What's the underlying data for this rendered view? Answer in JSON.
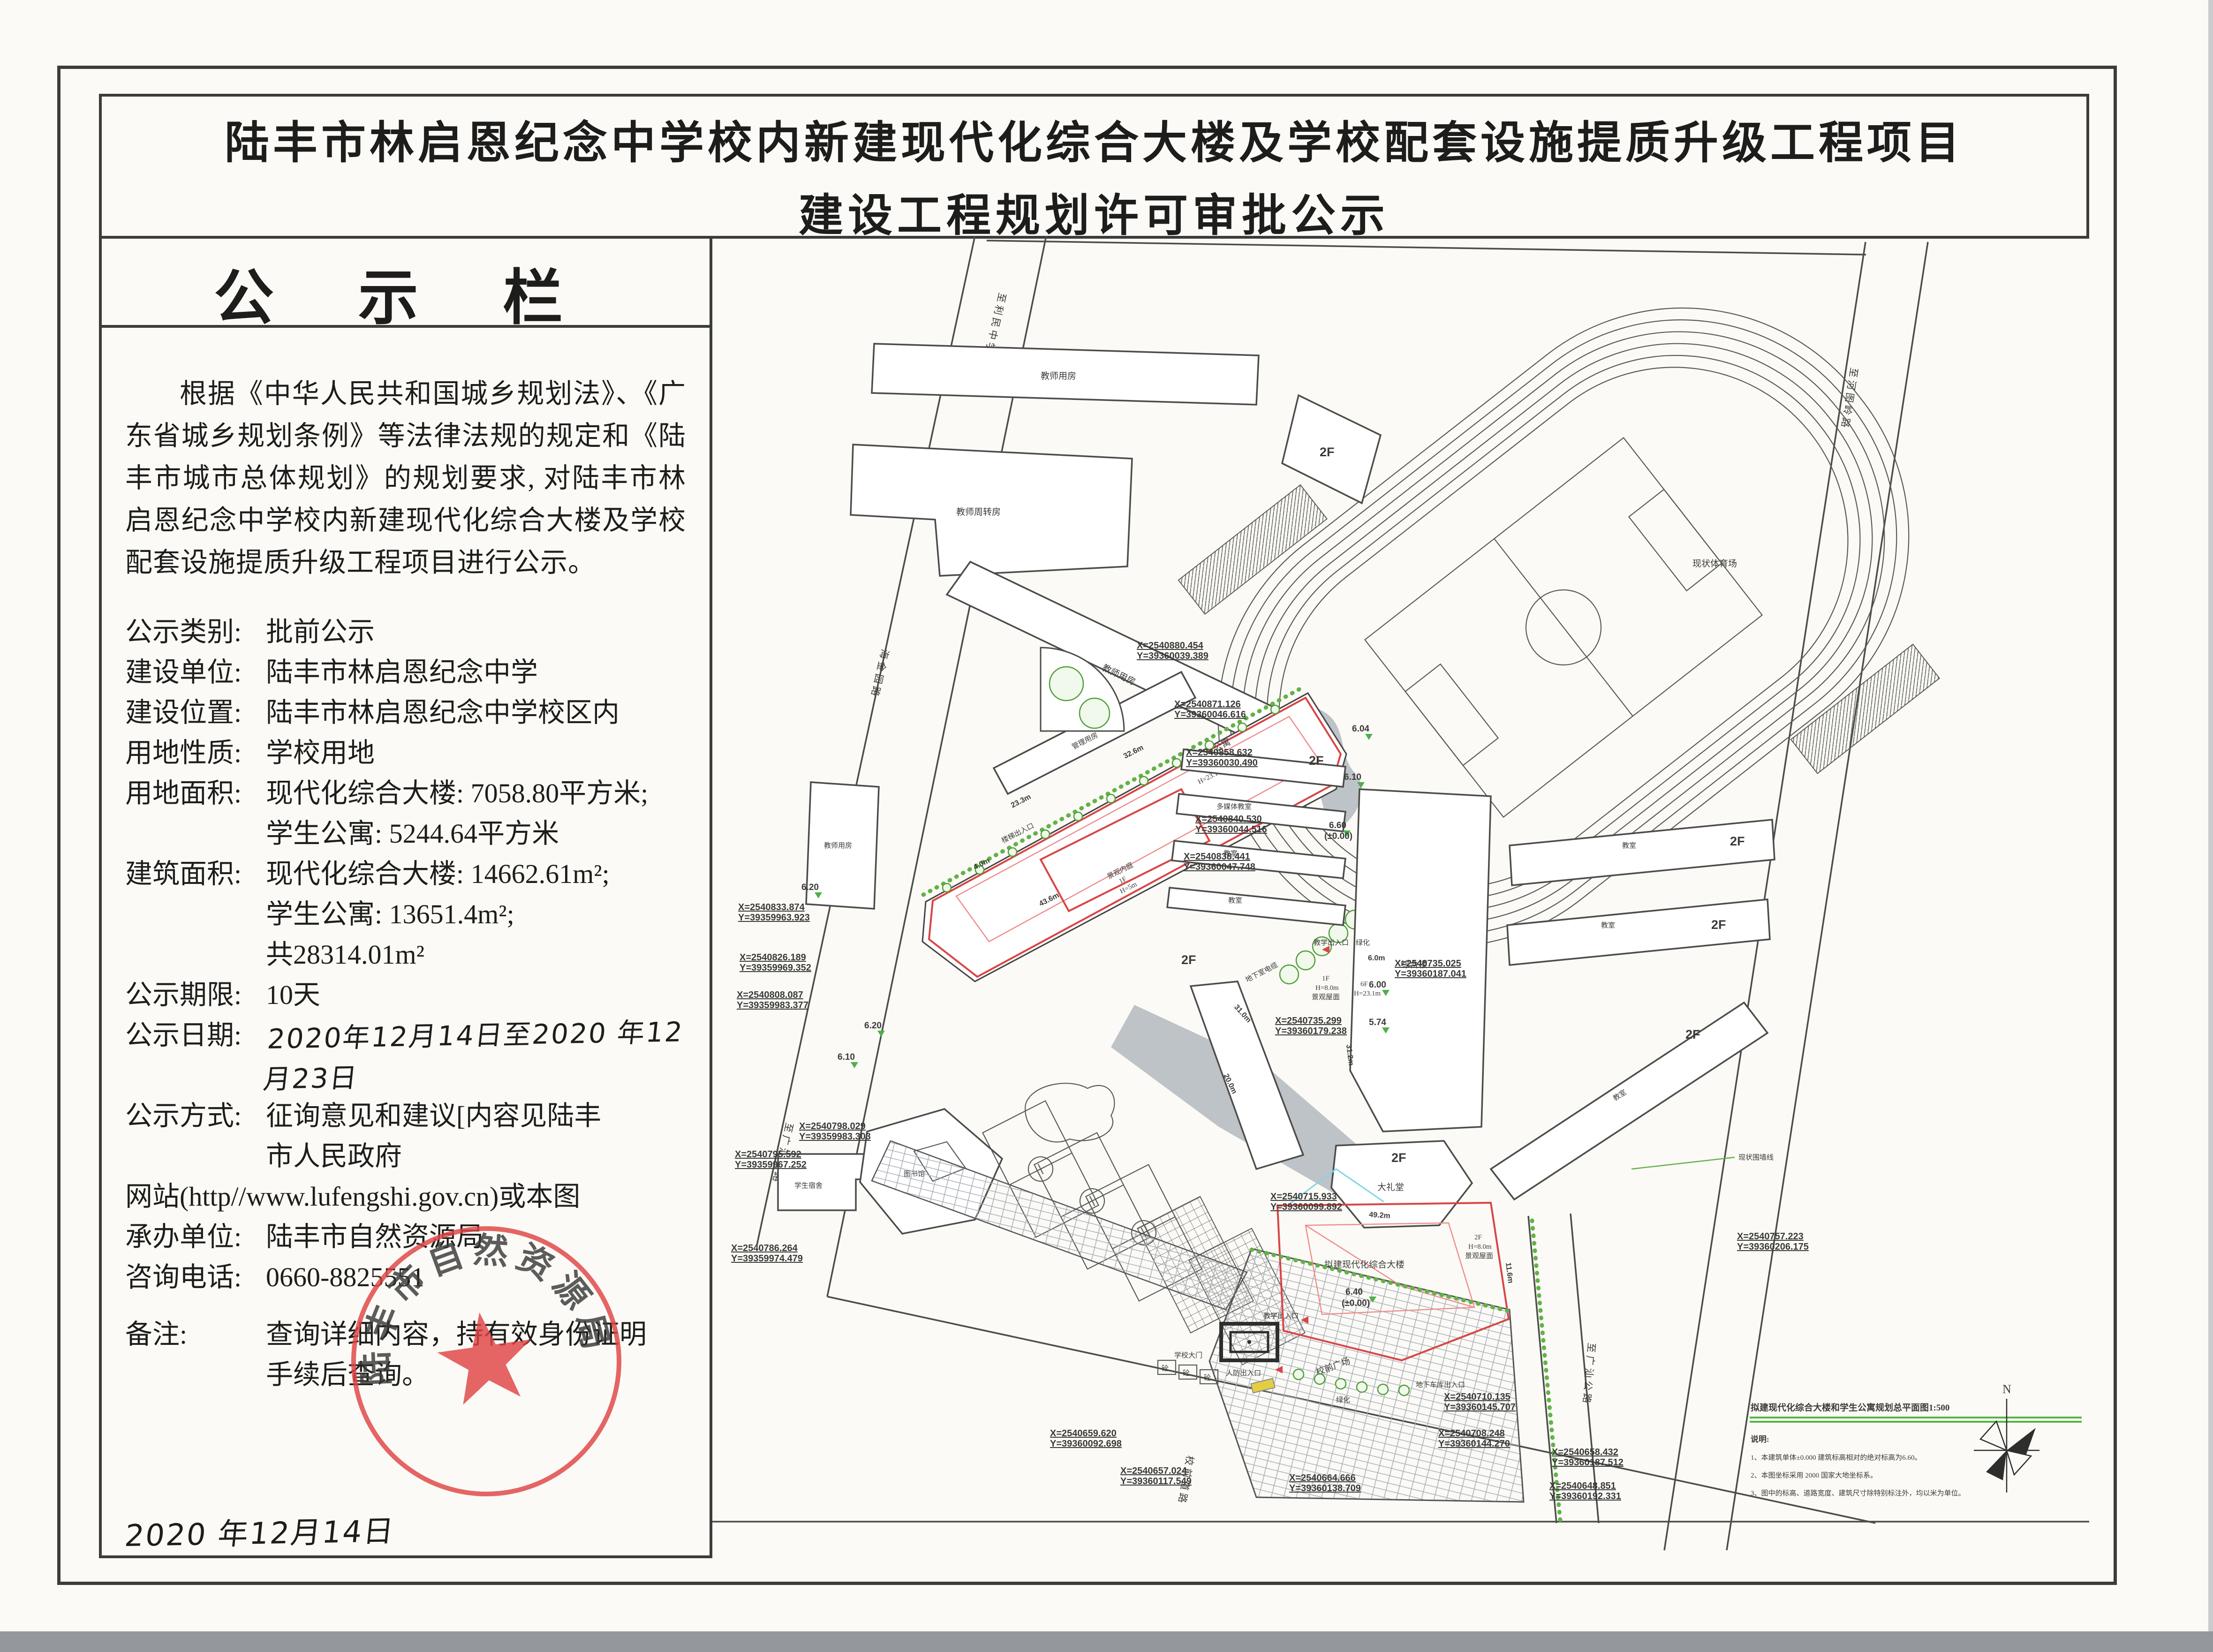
{
  "title": {
    "line1": "陆丰市林启恩纪念中学校内新建现代化综合大楼及学校配套设施提质升级工程项目",
    "line2": "建设工程规划许可审批公示"
  },
  "board": {
    "header": "公 示 栏",
    "intro": "根据《中华人民共和国城乡规划法》、《广东省城乡规划条例》等法律法规的规定和《陆丰市城市总体规划》的规划要求, 对陆丰市林启恩纪念中学校内新建现代化综合大楼及学校配套设施提质升级工程项目进行公示。",
    "fields": [
      {
        "label": "公示类别:",
        "value": "批前公示"
      },
      {
        "label": "建设单位:",
        "value": "陆丰市林启恩纪念中学"
      },
      {
        "label": "建设位置:",
        "value": "陆丰市林启恩纪念中学校区内"
      },
      {
        "label": "用地性质:",
        "value": "学校用地"
      },
      {
        "label": "用地面积:",
        "value": "现代化综合大楼: 7058.80平方米;",
        "value2": "学生公寓: 5244.64平方米"
      },
      {
        "label": "建筑面积:",
        "value": "现代化综合大楼: 14662.61m²;",
        "value2": "学生公寓: 13651.4m²;",
        "value3": "共28314.01m²"
      },
      {
        "label": "公示期限:",
        "value": "10天"
      },
      {
        "label": "公示日期:",
        "value": "2020年12月14日至2020 年12 月23日"
      },
      {
        "label": "公示方式:",
        "value": "征询意见和建议[内容见陆丰",
        "value2": "市人民政府"
      },
      {
        "label": "网站",
        "value": "(http//www.lufengshi.gov.cn)或本图"
      },
      {
        "label": "承办单位:",
        "value": "陆丰市自然资源局"
      },
      {
        "label": "咨询电话:",
        "value": "0660-8825551"
      },
      {
        "label": "备注:",
        "value": "查询详细内容，持有效身份证明",
        "value2": "手续后查询。"
      }
    ],
    "stamp": "陆丰市自然资源局",
    "sign_date": "2020 年12月14日"
  },
  "map": {
    "roads": {
      "to_limin": "至利民中学",
      "left_road": "海金园路",
      "to_guangshan_w": "至广汕公路",
      "to_hetuling": "至河图岭路",
      "to_guangshan_e": "至广汕公路",
      "xiaoqian": "校前道路"
    },
    "stadium": "现状体育场",
    "buildings": {
      "teacher": "教师用房",
      "teacher_turn": "教师周转房",
      "admin": "管理用房",
      "multimedia": "多媒体教室",
      "classroom": "教室",
      "complex": "综合楼",
      "hall": "大礼堂",
      "dorm": "学生宿舍",
      "library": "图书馆",
      "f2": "2F"
    },
    "proposed": {
      "apt": "拟建学生公寓",
      "apt_f": "6F",
      "apt_h": "H=23.10m",
      "court": "景观内庭",
      "court_f": "1F",
      "court_h": "H=5m",
      "main": "拟建现代化综合大楼",
      "elev_main": "6.40",
      "elev_main2": "(±0.00)",
      "elev_apt": "6.60",
      "elev_apt2": "(±0.00)"
    },
    "labels": {
      "teach_entry": "教学出入口",
      "civil_entry": "人防出入口",
      "gate": "学校大门",
      "garage": "地下车库出入口",
      "stair": "楼梯出入口",
      "green": "绿化",
      "conc": "砼",
      "cable": "地下室电缆",
      "wall": "现状围墙线",
      "plaza": "校前广场",
      "roof1a": "1F",
      "roof1b": "H=8.0m",
      "roof1c": "景观屋面",
      "roof6a": "6F",
      "roof6b": "H=23.1m",
      "roof2a": "2F",
      "roof2b": "H=8.0m",
      "roof2c": "景观屋面"
    },
    "elevations": [
      "6.20",
      "6.10",
      "6.04",
      "6.00",
      "5.74",
      "6.20",
      "6.10"
    ],
    "dims": [
      "6.0m",
      "20.0m",
      "31.0m",
      "31.2m",
      "49.2m",
      "32.6m",
      "11.6m",
      "23.3m",
      "43.6m",
      "4.0m"
    ],
    "coords": [
      {
        "x": "X=2540880.454",
        "y": "Y=39360039.389"
      },
      {
        "x": "X=2540871.126",
        "y": "Y=39360046.616"
      },
      {
        "x": "X=2540858.632",
        "y": "Y=39360030.490"
      },
      {
        "x": "X=2540840.530",
        "y": "Y=39360044.516"
      },
      {
        "x": "X=2540838.441",
        "y": "Y=39360047.748"
      },
      {
        "x": "X=2540757.223",
        "y": "Y=39360206.175"
      },
      {
        "x": "X=2540735.299",
        "y": "Y=39360179.238"
      },
      {
        "x": "X=2540735.025",
        "y": "Y=39360187.041"
      },
      {
        "x": "X=2540833.874",
        "y": "Y=39359963.923"
      },
      {
        "x": "X=2540826.189",
        "y": "Y=39359969.352"
      },
      {
        "x": "X=2540808.087",
        "y": "Y=39359983.377"
      },
      {
        "x": "X=2540798.029",
        "y": "Y=39359983.303"
      },
      {
        "x": "X=2540795.592",
        "y": "Y=39359967.252"
      },
      {
        "x": "X=2540786.264",
        "y": "Y=39359974.479"
      },
      {
        "x": "X=2540715.933",
        "y": "Y=39360099.892"
      },
      {
        "x": "X=2540710.135",
        "y": "Y=39360145.707"
      },
      {
        "x": "X=2540708.248",
        "y": "Y=39360144.270"
      },
      {
        "x": "X=2540659.620",
        "y": "Y=39360092.698"
      },
      {
        "x": "X=2540657.024",
        "y": "Y=39360117.549"
      },
      {
        "x": "X=2540664.666",
        "y": "Y=39360138.709"
      },
      {
        "x": "X=2540658.432",
        "y": "Y=39360187.512"
      },
      {
        "x": "X=2540648.851",
        "y": "Y=39360192.331"
      }
    ],
    "legend": {
      "title": "拟建现代化综合大楼和学生公寓规划总平面图1:500",
      "note_head": "说明:",
      "note1": "1、本建筑单体±0.000 建筑标高相对的绝对标高为6.60。",
      "note2": "2、本图坐标采用 2000 国家大地坐标系。",
      "note3": "3、图中的标高、道路宽度、建筑尺寸除特别标注外，均以米为单位。",
      "north": "N"
    }
  }
}
